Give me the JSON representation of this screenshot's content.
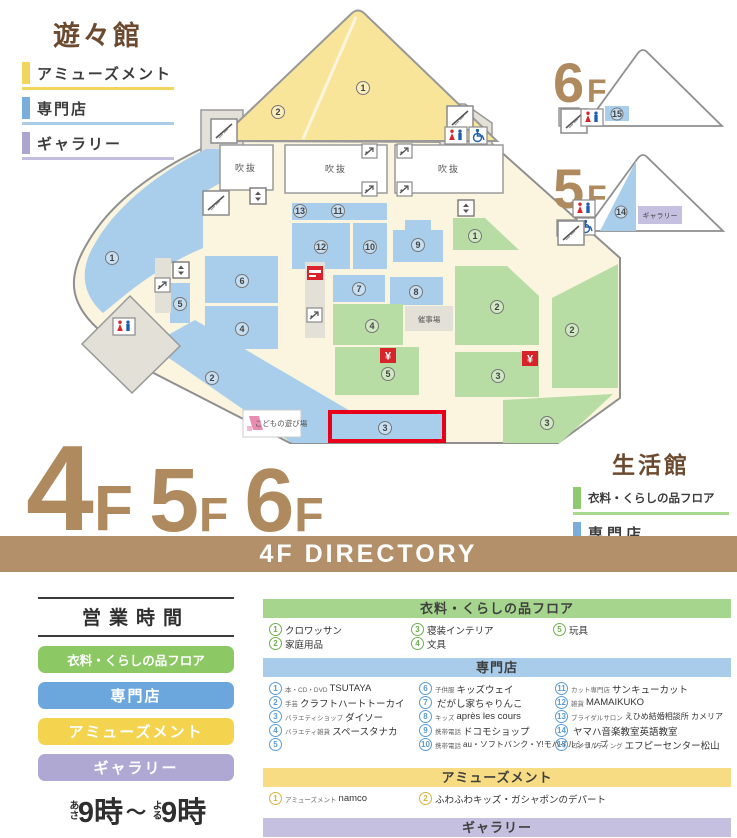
{
  "yuyukan": {
    "title": "遊々館",
    "legend": [
      {
        "label": "アミューズメント",
        "color": "#F2D55C"
      },
      {
        "label": "専門店",
        "color": "#79AEDC"
      },
      {
        "label": "ギャラリー",
        "color": "#ABA5CF"
      }
    ]
  },
  "seikatsukan": {
    "title": "生活館",
    "legend": [
      {
        "label": "衣料・くらしの品フロア",
        "color": "#8FCA70"
      },
      {
        "label": "専門店",
        "color": "#79AEDC"
      }
    ]
  },
  "floors": {
    "current": "4",
    "next1": "5",
    "next2": "6",
    "suffix": "F"
  },
  "banner": {
    "title": "4F DIRECTORY"
  },
  "map": {
    "atrium": "吹抜",
    "event_space": "催事場",
    "kids_area": "こどもの遊び場",
    "yen": "¥",
    "yellow": {
      "a1": "1",
      "a2": "2"
    },
    "blue": {
      "b1": "1",
      "b2": "2",
      "b3": "3",
      "b4": "4",
      "b5": "5",
      "b6": "6",
      "b7": "7",
      "b8": "8",
      "b9": "9",
      "b10": "10",
      "b11": "11",
      "b12": "12",
      "b13": "13"
    },
    "green": {
      "g1": "1",
      "g2a": "2",
      "g2b": "2",
      "g3a": "3",
      "g3b": "3",
      "g4": "4",
      "g5": "5"
    },
    "floor6": {
      "num": "6",
      "suffix": "F",
      "shop": "15"
    },
    "floor5": {
      "num": "5",
      "suffix": "F",
      "shop": "14",
      "gallery": "ギャラリー"
    }
  },
  "hours": {
    "title": "営業時間",
    "pills": [
      {
        "label": "衣料・くらしの品フロア",
        "color": "#8CC863"
      },
      {
        "label": "専門店",
        "color": "#6BA7DC"
      },
      {
        "label": "アミューズメント",
        "color": "#F4D44F"
      },
      {
        "label": "ギャラリー",
        "color": "#AFA8D3"
      }
    ],
    "open_prefix": "あさ",
    "open_time": "9時",
    "tilde": "〜",
    "close_prefix": "よる",
    "close_time": "9時",
    "note": "※一部店舗は営業時間が異なります。"
  },
  "directory": {
    "sections": [
      {
        "title": "衣料・くらしの品フロア",
        "color": "#A6D58E",
        "items": [
          {
            "num": "1",
            "prefix": "",
            "name": "クロワッサン"
          },
          {
            "num": "2",
            "prefix": "",
            "name": "家庭用品"
          },
          {
            "num": "3",
            "prefix": "",
            "name": "寝装インテリア"
          },
          {
            "num": "4",
            "prefix": "",
            "name": "文具"
          },
          {
            "num": "5",
            "prefix": "",
            "name": "玩具"
          }
        ]
      },
      {
        "title": "専門店",
        "color": "#A8CCEA",
        "items": [
          {
            "num": "1",
            "prefix": "本・CD・DVD",
            "name": "TSUTAYA"
          },
          {
            "num": "2",
            "prefix": "手芸",
            "name": "クラフトハートトーカイ"
          },
          {
            "num": "3",
            "prefix": "バラエティショップ",
            "name": "ダイソー"
          },
          {
            "num": "4",
            "prefix": "バラエティ雑貨",
            "name": "スペースタナカ"
          },
          {
            "num": "5",
            "prefix": "",
            "name": ""
          },
          {
            "num": "6",
            "prefix": "子供服",
            "name": "キッズウェイ"
          },
          {
            "num": "7",
            "prefix": "",
            "name": "だがし家ちゃりんこ"
          },
          {
            "num": "8",
            "prefix": "キッズ",
            "name": "après les cours"
          },
          {
            "num": "9",
            "prefix": "携帯電話",
            "name": "ドコモショップ"
          },
          {
            "num": "10",
            "prefix": "携帯電話",
            "name": "au・ソフトバンク・Y!モバイルショップ"
          },
          {
            "num": "11",
            "prefix": "カット専門店",
            "name": "サンキューカット"
          },
          {
            "num": "12",
            "prefix": "雑貨",
            "name": "MAMAIKUKO"
          },
          {
            "num": "13",
            "prefix": "ブライダルサロン",
            "name": "えひめ結婚相談所 カメリア"
          },
          {
            "num": "14",
            "prefix": "",
            "name": "ヤマハ音楽教室英語教室"
          },
          {
            "num": "15",
            "prefix": "コンサルティング",
            "name": "エフピーセンター松山"
          }
        ]
      },
      {
        "title": "アミューズメント",
        "color": "#F8DC84",
        "items": [
          {
            "num": "1",
            "prefix": "アミューズメント",
            "name": "namco"
          },
          {
            "num": "2",
            "prefix": "",
            "name": "ふわふわキッズ・ガシャポンのデパート"
          }
        ]
      },
      {
        "title": "ギャラリー",
        "color": "#C5C0DF",
        "items": []
      }
    ]
  },
  "colors": {
    "brown_banner": "#B3906A",
    "brown_text": "#B08A5F",
    "brown_dark": "#6B4A2F",
    "area_yellow": "#F8E59A",
    "area_blue": "#A8CEEB",
    "area_green": "#B7DDA4",
    "area_lavender": "#C5C0DF",
    "map_floor": "#FBF5DF",
    "highlight_red": "#E8001A"
  }
}
